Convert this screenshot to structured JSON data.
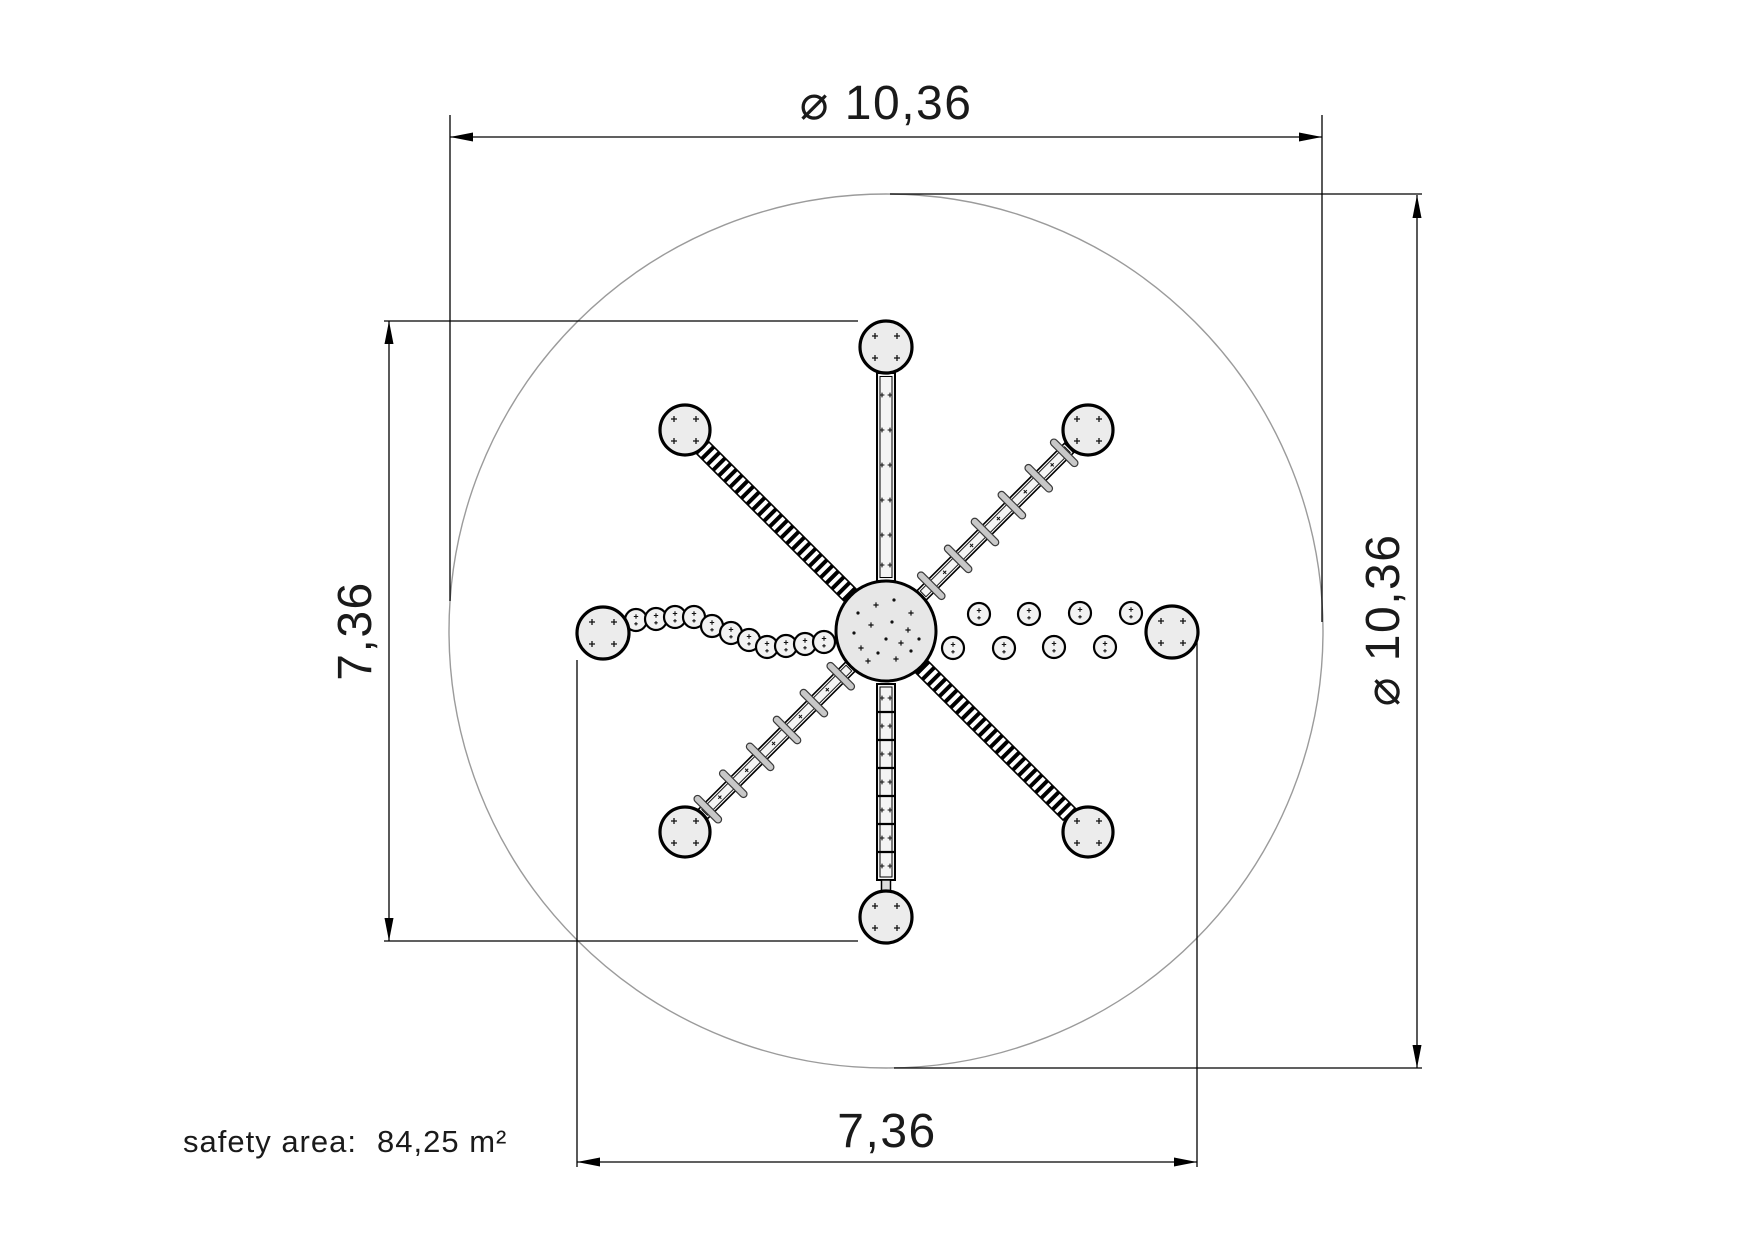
{
  "dimensions": {
    "top": "⌀ 10,36",
    "right": "⌀ 10,36",
    "left": "7,36",
    "bottom": "7,36"
  },
  "safety_area": {
    "label": "safety area:",
    "value": "84,25 m²"
  },
  "colors": {
    "line": "#000000",
    "guide": "#9b9b9b",
    "platform_fill": "#ececec",
    "hub_fill": "#e7e7e7",
    "pod_fill": "#f2f2f2",
    "rung_fill": "#c8c8c8",
    "text": "#1a1a1a"
  },
  "drawing": {
    "scale_px_per_m": 84.25,
    "safety_circle": {
      "cx": 886,
      "cy": 631,
      "r": 437
    },
    "hub": {
      "cx": 886,
      "cy": 631,
      "r": 50,
      "marks": [
        [
          -28,
          -18
        ],
        [
          -10,
          -26
        ],
        [
          8,
          -31
        ],
        [
          25,
          -18
        ],
        [
          -32,
          2
        ],
        [
          -15,
          -6
        ],
        [
          6,
          -9
        ],
        [
          22,
          -1
        ],
        [
          33,
          8
        ],
        [
          -25,
          17
        ],
        [
          -8,
          22
        ],
        [
          10,
          28
        ],
        [
          25,
          20
        ],
        [
          -18,
          30
        ],
        [
          0,
          8
        ],
        [
          15,
          12
        ]
      ]
    },
    "platforms": [
      {
        "id": "north",
        "cx": 886,
        "cy": 347,
        "r": 26
      },
      {
        "id": "south",
        "cx": 886,
        "cy": 917,
        "r": 26
      },
      {
        "id": "west",
        "cx": 603,
        "cy": 633,
        "r": 26
      },
      {
        "id": "east",
        "cx": 1172,
        "cy": 632,
        "r": 26
      },
      {
        "id": "northwest",
        "cx": 685,
        "cy": 430,
        "r": 25
      },
      {
        "id": "northeast",
        "cx": 1088,
        "cy": 430,
        "r": 25
      },
      {
        "id": "southwest",
        "cx": 685,
        "cy": 832,
        "r": 25
      },
      {
        "id": "southeast",
        "cx": 1088,
        "cy": 832,
        "r": 25
      }
    ],
    "pod_r": 11,
    "west_pods": [
      [
        636,
        620
      ],
      [
        656,
        619
      ],
      [
        675,
        617
      ],
      [
        694,
        617
      ],
      [
        712,
        626
      ],
      [
        731,
        633
      ],
      [
        749,
        640
      ],
      [
        767,
        647
      ],
      [
        786,
        646
      ],
      [
        805,
        644
      ],
      [
        824,
        642
      ]
    ],
    "east_pods": [
      [
        979,
        614
      ],
      [
        1029,
        614
      ],
      [
        1080,
        613
      ],
      [
        1131,
        613
      ],
      [
        953,
        648
      ],
      [
        1004,
        648
      ],
      [
        1054,
        647
      ],
      [
        1105,
        647
      ]
    ],
    "ladder": {
      "x": 877,
      "y": 684,
      "w": 18,
      "h": 196,
      "rung_start": 712,
      "rung_step": 28,
      "rung_count": 6
    },
    "beam": {
      "x": 877,
      "y": 373,
      "w": 18,
      "h": 208,
      "mark_ys": [
        395,
        430,
        465,
        500,
        535,
        565
      ]
    },
    "rung_bands": {
      "angles_deg": [
        -45,
        135
      ],
      "s0": 50,
      "s1": 259,
      "width": 13,
      "rung_s": [
        64,
        102,
        140,
        178,
        216,
        252
      ],
      "mark_s": [
        83,
        121,
        159,
        197,
        235
      ]
    },
    "hatch_bands": {
      "angles_deg": [
        -135,
        45
      ],
      "s0": 50,
      "s1": 259,
      "width": 17
    }
  }
}
